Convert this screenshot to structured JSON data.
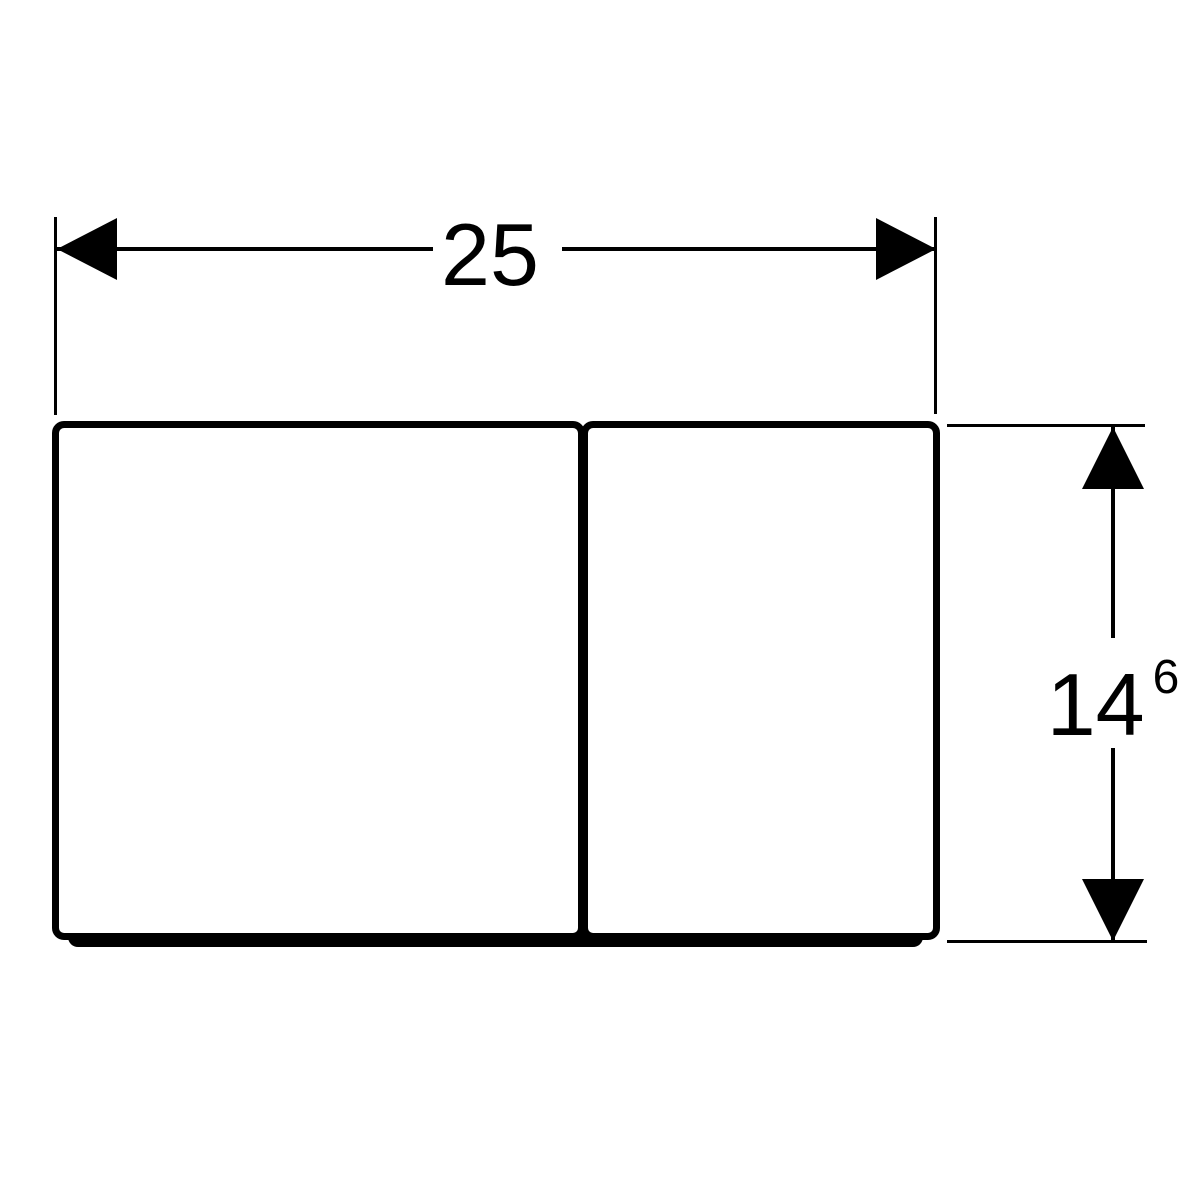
{
  "canvas": {
    "background": "#ffffff",
    "line_color": "#000000"
  },
  "dimensions": {
    "width": {
      "label": "25"
    },
    "height": {
      "label": "14",
      "superscript": "6"
    }
  },
  "icons": {
    "arrow_left": "filled-triangle-left",
    "arrow_right": "filled-triangle-right",
    "arrow_up": "filled-triangle-up",
    "arrow_down": "filled-triangle-down"
  }
}
